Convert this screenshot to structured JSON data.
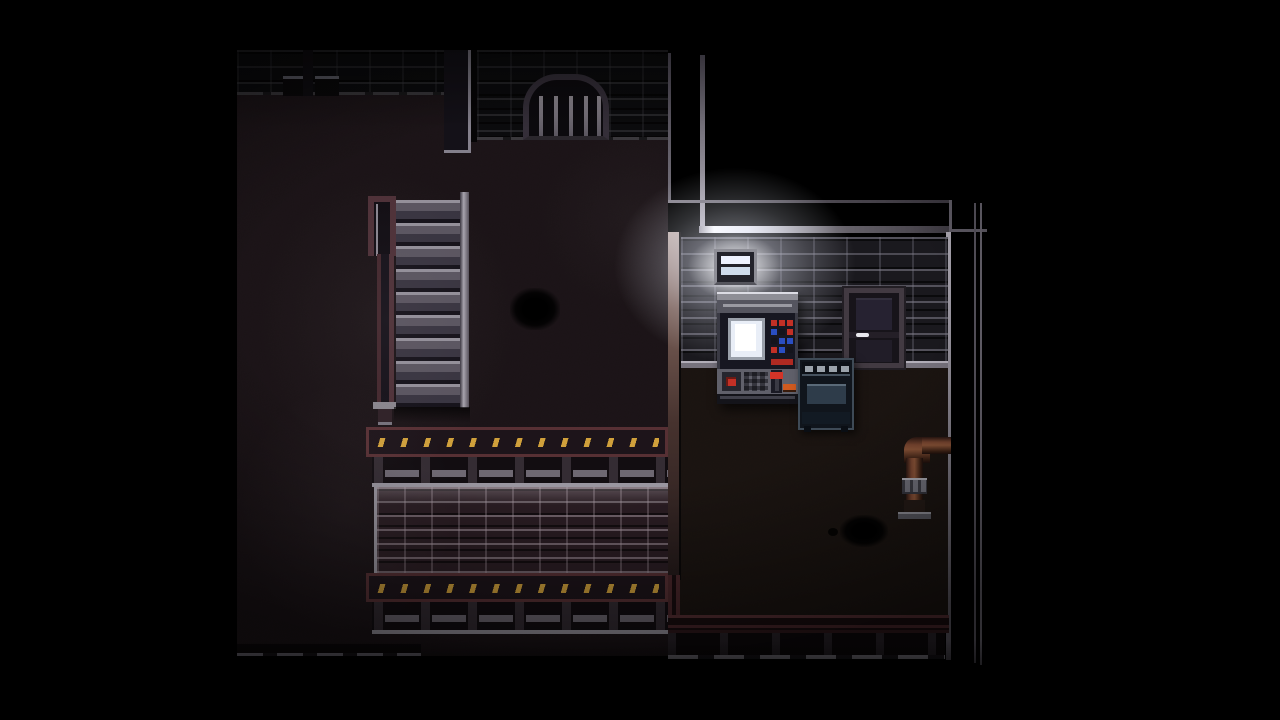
{
  "scene": {
    "description": "Dark top-down pixel-art basement interior: staircase with maroon railing, arched drain grate in the top wall, brick parapet with yellow caution stripes, and a lamp-lit alcove containing a control panel, metal door, stove and copper wall pipe",
    "style": "retro pixel RPG screenshot",
    "letterbox": "black side bars"
  },
  "palette": {
    "floor_left": "#1a1316",
    "floor_right": "#191310",
    "wall_brick_base": "#1b1a20",
    "parapet_brick_base": "#2a1d23",
    "maroon_frame": "#573034",
    "caution_yellow": "#d9a73d",
    "metal_light": "#9a96a0",
    "railing_maroon": "#4e3138",
    "stair_tread": "#94909a",
    "lamp_white": "#eef2ff",
    "screen_blue": "#e9eef7",
    "button_red": "#c23026",
    "button_blue": "#2a4ec2",
    "lever_red": "#d23428",
    "handle_orange": "#cf5a1f",
    "pipe_copper": "#8a5438",
    "door_frame": "#423a42",
    "stove_body": "#1c2530"
  },
  "objects": {
    "staircase": {
      "label": "Staircase"
    },
    "stair_railing": {
      "label": "Stair railing"
    },
    "arched_grate": {
      "label": "Arched drain grate"
    },
    "caution_ledge": {
      "label": "Caution-striped ledge"
    },
    "guard_railing": {
      "label": "Guard railing"
    },
    "brick_parapet": {
      "label": "Brick parapet wall"
    },
    "wall_lamp": {
      "label": "Wall lamp"
    },
    "control_panel": {
      "label": "Control panel"
    },
    "panel_screen": {
      "label": "Control panel screen"
    },
    "panel_keypad": {
      "label": "Keypad"
    },
    "panel_lever": {
      "label": "Red lever"
    },
    "metal_door": {
      "label": "Metal door"
    },
    "door_handle": {
      "label": "Door handle"
    },
    "stove": {
      "label": "Stove"
    },
    "wall_pipe": {
      "label": "Copper wall pipe"
    },
    "floor_stain": {
      "label": "Dark floor stain"
    }
  },
  "panel_buttons": {
    "grid_colors": [
      [
        "#c23026",
        "#c23026",
        "#c23026"
      ],
      [
        "#2a4ec2",
        "#14141c",
        "#c23026"
      ],
      [
        "#14141c",
        "#2a4ec2",
        "#2a4ec2"
      ],
      [
        "#c23026",
        "#2a4ec2",
        "#14141c"
      ]
    ]
  }
}
